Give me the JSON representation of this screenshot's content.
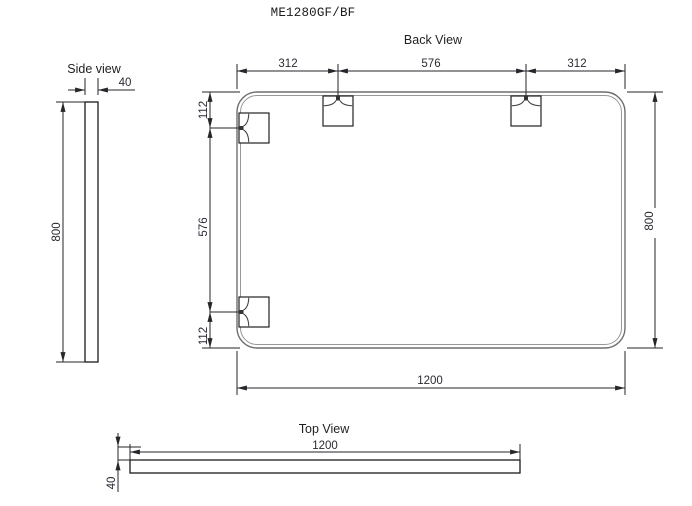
{
  "title": "ME1280GF/BF",
  "colors": {
    "line": "#26262b",
    "mirror_outline": "#6f6f6f",
    "text": "#1d1d1f",
    "background": "#ffffff"
  },
  "back_view": {
    "label": "Back View",
    "dims": {
      "top": [
        "312",
        "576",
        "312"
      ],
      "left": [
        "112",
        "576",
        "112"
      ],
      "right": "800",
      "bottom": "1200"
    }
  },
  "side_view": {
    "label": "Side view",
    "dims": {
      "width": "40",
      "height": "800"
    }
  },
  "top_view": {
    "label": "Top View",
    "dims": {
      "length": "1200",
      "thickness": "40"
    }
  }
}
